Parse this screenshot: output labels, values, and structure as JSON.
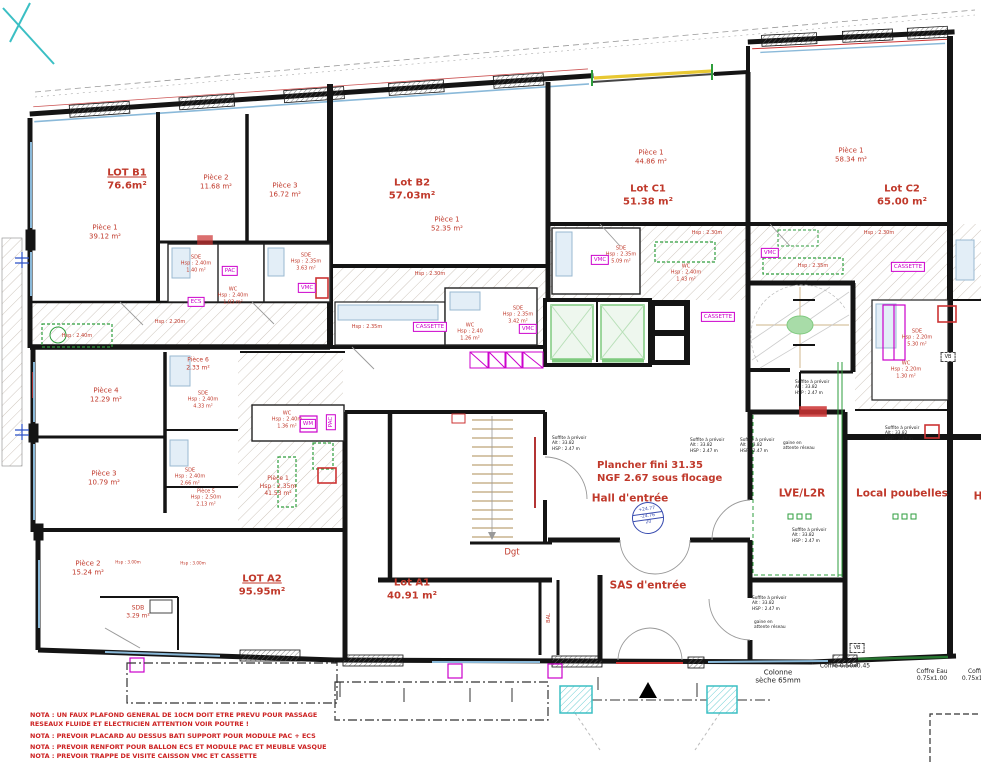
{
  "lots": {
    "b1": {
      "name": "LOT B1",
      "area": "76.6m²"
    },
    "b2": {
      "name": "Lot B2",
      "area": "57.03m²"
    },
    "c1": {
      "name": "Lot C1",
      "area": "51.38 m²"
    },
    "c2": {
      "name": "Lot C2",
      "area": "65.00 m²"
    },
    "a1": {
      "name": "Lot A1",
      "area": "40.91 m²"
    },
    "a2": {
      "name": "LOT A2",
      "area": "95.95m²"
    }
  },
  "rooms": {
    "b1_p1": {
      "l1": "Pièce 1",
      "l2": "39.12 m²"
    },
    "b1_p2": {
      "l1": "Pièce 2",
      "l2": "11.68 m²"
    },
    "b1_p3": {
      "l1": "Pièce 3",
      "l2": "16.72 m²"
    },
    "b2_p1": {
      "l1": "Pièce 1",
      "l2": "52.35 m²"
    },
    "c1_p1": {
      "l1": "Pièce 1",
      "l2": "44.86 m²"
    },
    "c2_p1": {
      "l1": "Pièce 1",
      "l2": "58.34 m²"
    },
    "a2_p1": {
      "l1": "Pièce 1",
      "l2": "Hsp : 2.35m",
      "l3": "41.53 m²"
    },
    "a2_p2": {
      "l1": "Pièce 2",
      "l2": "15.24 m²"
    },
    "a2_p3": {
      "l1": "Pièce 3",
      "l2": "10.79 m²"
    },
    "a2_p4": {
      "l1": "Pièce 4",
      "l2": "12.29 m²"
    },
    "a2_p5": {
      "l1": "Pièce 5",
      "l2": "Hsp : 2.50m",
      "l3": "2.13 m²"
    },
    "a2_p6": {
      "l1": "Pièce 6",
      "l2": "2.33 m²"
    }
  },
  "wet": {
    "b1_sde1": {
      "l1": "SDE",
      "l2": "Hsp : 2.40m",
      "l3": "1.40 m²"
    },
    "b1_wc": {
      "l1": "WC",
      "l2": "Hsp : 2.40m",
      "l3": "1.03 m²"
    },
    "b1_sde2": {
      "l1": "SDE",
      "l2": "Hsp : 2.35m",
      "l3": "3.63 m²"
    },
    "b2_wc": {
      "l1": "WC",
      "l2": "Hsp : 2.40",
      "l3": "1.26 m²"
    },
    "b2_sde": {
      "l1": "SDE",
      "l2": "Hsp : 2.35m",
      "l3": "3.42 m²"
    },
    "c1_sde": {
      "l1": "SDE",
      "l2": "Hsp : 2.35m",
      "l3": "5.09 m²"
    },
    "c1_wc": {
      "l1": "WC",
      "l2": "Hsp : 2.40m",
      "l3": "1.43 m²"
    },
    "c2_sde": {
      "l1": "SDE",
      "l2": "Hsp : 2.20m",
      "l3": "5.30 m²"
    },
    "c2_wc": {
      "l1": "WC",
      "l2": "Hsp : 2.20m",
      "l3": "1.30 m²"
    },
    "a2_sde1": {
      "l1": "SDE",
      "l2": "Hsp : 2.40m",
      "l3": "4.33 m²"
    },
    "a2_sde2": {
      "l1": "SDE",
      "l2": "Hsp : 2.40m",
      "l3": "2.66 m²"
    },
    "a2_wc": {
      "l1": "WC",
      "l2": "Hsp : 2.40m",
      "l3": "1.36 m²"
    },
    "a2_sdb": {
      "l1": "SDB",
      "l2": "3.29 m²"
    }
  },
  "hsp": {
    "h220": "Hsp : 2.20m",
    "h230": "Hsp : 2.30m",
    "h235": "Hsp : 2.35m",
    "h240": "Hsp : 2.40m",
    "h300": "Hsp : 3.00m"
  },
  "areas": {
    "hall": "Hall d'entrée",
    "sas": "SAS d'entrée",
    "dgt": "Dgt",
    "bal": "BAL",
    "lve": "LVE/L2R",
    "poubelles": "Local poubelles",
    "hall_right": "H",
    "plancher_l1": "Plancher fini 31.35",
    "plancher_l2": "NGF 2.67 sous flocage"
  },
  "equipment": {
    "cassette": "CASSETTE",
    "vmc": "VMC",
    "pac": "PAC",
    "wm": "WM",
    "ecs": "ECS",
    "vb": "VB"
  },
  "soffite": {
    "l1": "Soffite à prévoir",
    "l2": "Alt : 33.82",
    "l3": "HSP : 2.47 m"
  },
  "gaine": {
    "l1": "gaine en",
    "l2": "attente réseau"
  },
  "tech": {
    "colonne_l1": "Colonne",
    "colonne_l2": "sèche 65mm",
    "coffre1": "Coffre 0.50x0.45",
    "coffre_eau_l1": "Coffre Eau",
    "coffre_eau_l2": "0.75x1.00",
    "coffre2_l1": "Coffre",
    "coffre2_l2": "0.75x1.00"
  },
  "stamp": {
    "l1": "+24.77",
    "l2": "-24.76",
    "l3": "20"
  },
  "notes": [
    "NOTA : UN FAUX PLAFOND GENERAL DE 10CM DOIT ETRE PREVU POUR PASSAGE",
    "RESEAUX FLUIDE ET ELECTRICIEN ATTENTION VOIR POUTRE !",
    "NOTA : PREVOIR PLACARD AU DESSUS BATI SUPPORT POUR MODULE PAC + ECS",
    "NOTA : PREVOIR RENFORT POUR BALLON ECS ET MODULE PAC ET MEUBLE VASQUE",
    "NOTA : PREVOIR TRAPPE DE VISITE CAISSON VMC ET CASSETTE"
  ],
  "colors": {
    "label_red": "#c0392b",
    "note_red": "#cc2222",
    "magenta": "#cc00cc",
    "green": "#2e9e3c",
    "cyan": "#3bbfc4",
    "window_blue": "#8ab9d9",
    "wall_black": "#141414",
    "hatch_gray": "#c2b8ac",
    "stair_tan": "#c9b48e",
    "elevator_green": "#7fca7f",
    "bay_yellow": "#e8c832"
  }
}
